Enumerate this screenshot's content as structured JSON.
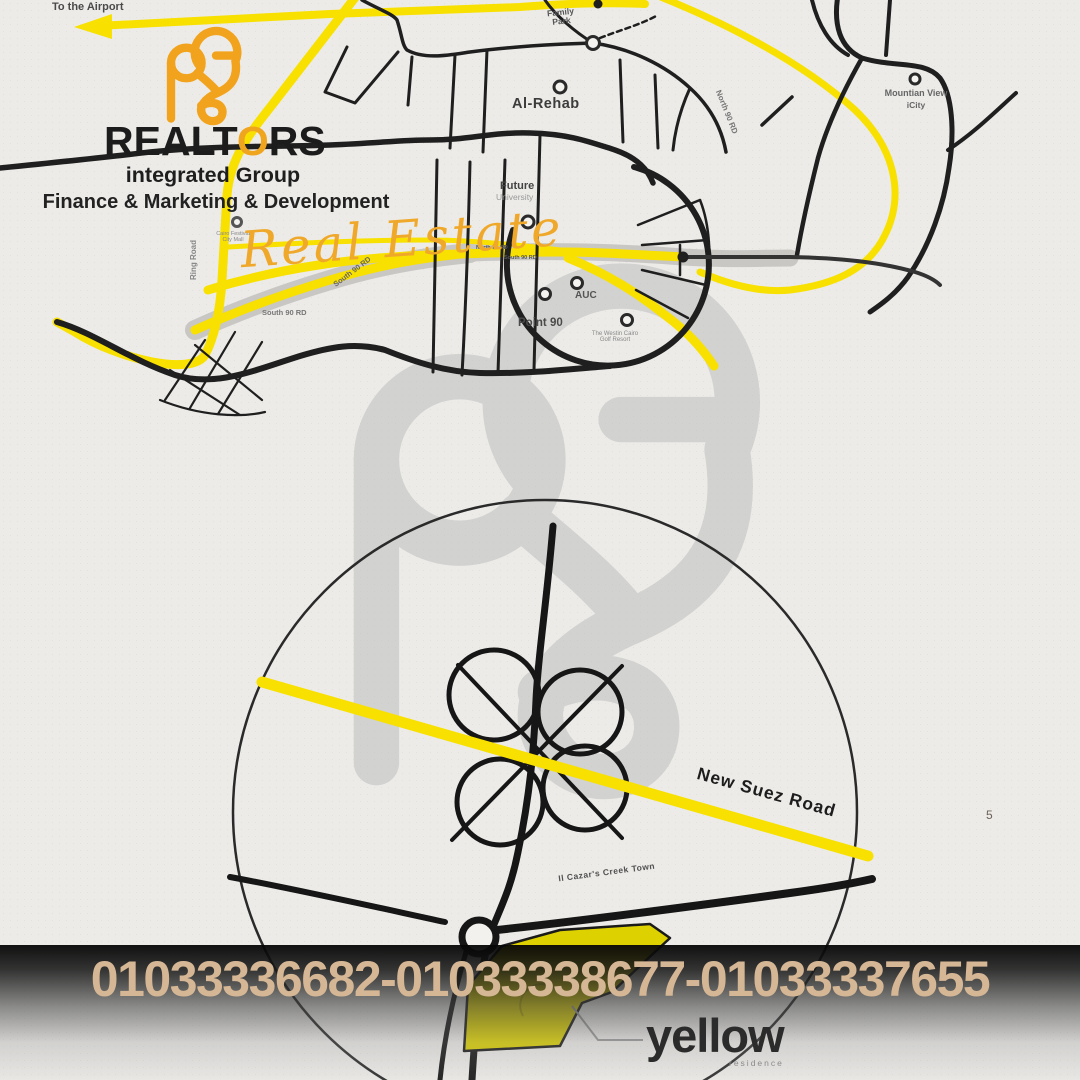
{
  "branding": {
    "wordmark": {
      "pre": "REALT",
      "o": "O",
      "post": "RS"
    },
    "subtitle": "integrated Group",
    "tagline": "Finance & Marketing & Development",
    "script": "Real Estate"
  },
  "map_top": {
    "airport": "To the Airport",
    "family_park": "Family Park",
    "al_rehab": "Al-Rehab",
    "future": "Future",
    "university": "University",
    "auc": "AUC",
    "point_90": "Point 90",
    "golf_resort": "The Westin Cairo Golf Resort",
    "mountain_view": "Mountian View",
    "icity": "iCity",
    "north_90_arc": "North 90 RD",
    "north_90_corridor": "North 90 RD",
    "south_90_corridor": "South 90 RD",
    "south_90_diag": "South 90 RD",
    "south_90_h": "South 90 RD",
    "ring_road": "Ring Road",
    "cfc": "Cairo Festival City Mall"
  },
  "map_bottom": {
    "new_suez_road": "New Suez Road",
    "creek_town": "Il Cazar's Creek Town"
  },
  "project": {
    "name": "yellow",
    "subtitle": "residence"
  },
  "contact": {
    "phones": "01033336682-01033338677-01033337655"
  },
  "page": {
    "number": "5"
  },
  "colors": {
    "accent_orange": "#F2A31D",
    "road_yellow": "#F8E000",
    "road_black": "#1F1F1F",
    "corridor_gray": "#C8C7C4",
    "phone_text": "#D6B795",
    "watermark_gray": "#BCBCBC",
    "parcel_yellow": "#DDD200",
    "background": "#ECEBE8"
  }
}
